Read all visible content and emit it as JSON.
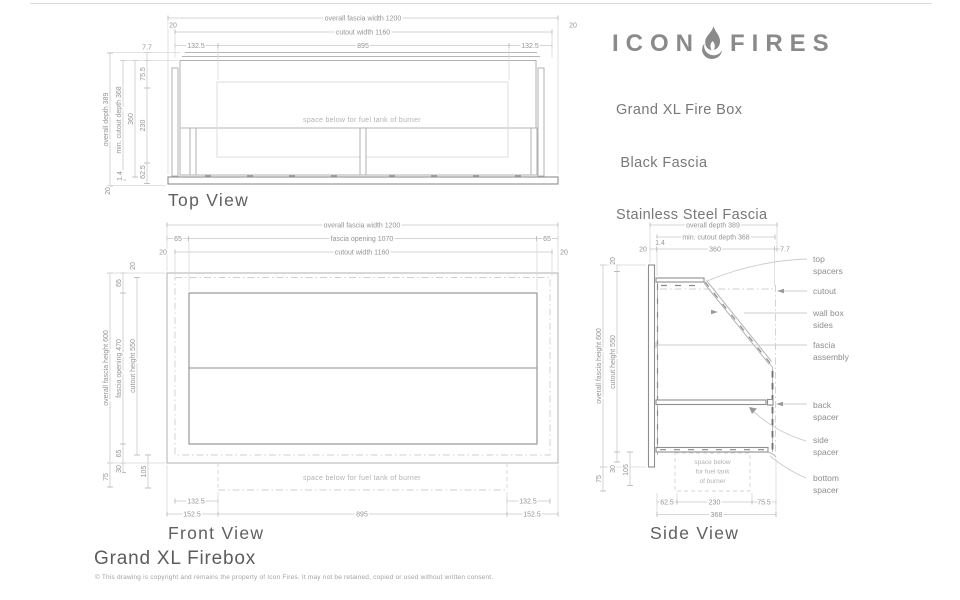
{
  "sheet": {
    "brand": {
      "word_left": "ICON",
      "word_right": "FIRES"
    },
    "product": {
      "line1": "Grand XL Fire Box",
      "line2": " Black Fascia",
      "line3": "Stainless Steel Fascia"
    },
    "footer": {
      "title": "Grand XL Firebox",
      "copyright": "© This drawing is copyright and remains the property of Icon Fires. It may not be retained, copied or used without written consent."
    },
    "colors": {
      "brand": "#8a8a8a",
      "line": "#b6b6b6",
      "dark_line": "#8e8e8e",
      "dim_text": "#949494",
      "heading": "#606060"
    }
  },
  "top_view": {
    "label": "Top View",
    "note": "space below for fuel tank of burner",
    "h": {
      "overall": "overall fascia width 1200",
      "cutout": "cutout width 1160",
      "seg_left": "132.5",
      "seg_mid": "895",
      "seg_right": "132.5",
      "end_left": "20",
      "end_right": "20"
    },
    "v": {
      "overall_depth": "overall depth 389",
      "min_cutout_depth": "min. cutout depth 368",
      "box_depth": "360",
      "m77": "7.7",
      "m755": "75.5",
      "m230": "230",
      "m625": "62.5",
      "m14": "1.4",
      "m20": "20"
    }
  },
  "front_view": {
    "label": "Front View",
    "note": "space below for fuel tank of burner",
    "h": {
      "overall": "overall fascia width 1200",
      "opening": "fascia opening 1070",
      "cutout": "cutout width 1160",
      "m65_left": "65",
      "m65_right": "65",
      "m20_left": "20",
      "m20_right": "20",
      "b132_left": "132.5",
      "b132_right": "132.5",
      "b152_left": "152.5",
      "b895": "895",
      "b152_right": "152.5"
    },
    "v": {
      "overall": "overall fascia height 600",
      "opening": "fascia opening 470",
      "cutout": "cutout height 550",
      "m20_top": "20",
      "m65_top": "65",
      "m65_bot": "65",
      "m30": "30",
      "m105": "105",
      "m75": "75"
    }
  },
  "side_view": {
    "label": "Side View",
    "note1": "space below",
    "note2": "for fuel tank",
    "note3": "of burner",
    "h": {
      "overall": "overall depth 389",
      "min_cutout": "min. cutout depth 368",
      "m20": "20",
      "m14": "1.4",
      "m360": "360",
      "m77": "7.7",
      "b625": "62.5",
      "b230": "230",
      "b755": "75.5",
      "b368": "368"
    },
    "v": {
      "overall": "overall fascia height 600",
      "cutout": "cutout height 550",
      "m20_top": "20",
      "m30": "30",
      "m105": "105",
      "m75": "75"
    },
    "callouts": {
      "top_spacers_1": "top",
      "top_spacers_2": "spacers",
      "cutout": "cutout",
      "wall_box_1": "wall box",
      "wall_box_2": "sides",
      "fascia_1": "fascia",
      "fascia_2": "assembly",
      "back_1": "back",
      "back_2": "spacer",
      "side_1": "side",
      "side_2": "spacer",
      "bottom_1": "bottom",
      "bottom_2": "spacer"
    }
  }
}
